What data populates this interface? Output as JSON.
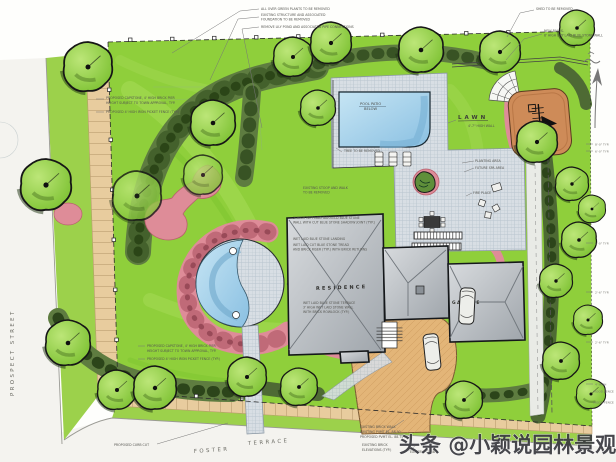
{
  "streets": {
    "prospect": "PROSPECT STREET",
    "foster": "FOSTER",
    "terrace": "TERRACE"
  },
  "labels": {
    "lawn": "LAWN",
    "residence": "RESIDENCE",
    "garage": "GARAGE",
    "pool_1": "POOL PATIO",
    "pool_2": "BELOW",
    "fire_place": "FIRE PLACE",
    "planting_area": "PLANTING AREA",
    "future_spa": "FUTURE SPA AREA"
  },
  "notes": {
    "green_plants": "ALL OVER GREEN PLANTS TO BE REMOVED",
    "existing_structure_1": "EXISTING STRUCTURE AND ASSOCIATED",
    "existing_structure_2": "FOUNDATION TO BE REMOVED",
    "lily_pond": "REMOVE LILY POND AND ASSOCIATED PIPE CONNECTIONS",
    "shed": "SHED TO BE REMOVED",
    "wall_1": "NEW BALUS.",
    "wall_2": "8' HIGH DRY LAID BLUE STONE WALL",
    "pier_a1": "PROPOSED CAPSTONE, 4' HIGH BRICK PIER",
    "pier_a2": "HEIGHT SUBJECT TO TOWN APPROVAL, TYP.",
    "fence_a": "PROPOSED 4' HIGH IRON PICKET FENCE (TYP.)",
    "pier_b1": "PROPOSED CAPSTONE, 4' HIGH BRICK PIER",
    "pier_b2": "HEIGHT SUBJECT TO TOWN APPROVAL, TYP.",
    "fence_b": "PROPOSED 4' HIGH IRON PICKET FENCE (TYP.)",
    "stoop_1": "EXISTING STOOP AND WALK",
    "stoop_2": "TO BE REMOVED",
    "wall_house_1": "3' HIGH WET LAID GARFIELD BLUE STONE",
    "wall_house_2": "WALL WITH CUT BLUE STONE SHADOW JOINT (TYP.)",
    "landing": "WET LAID BLUE STONE LANDING",
    "tread_1": "WET LAID CUT BLUE STONE TREAD",
    "tread_2": "AND BRICK RISER (TYP.) WITH BRICK RETURNS",
    "terrace_1": "WET LAID BLUE STONE TERRACE",
    "terrace_2": "3' HIGH WET LAID STONE WALL",
    "terrace_3": "WITH BRICK ROWLOCK (TYP.)",
    "tree_removed": "TREE TO BE REMOVED",
    "wall_hgt": "4'-7\" HIGH WALL",
    "curb_cut": "PROPOSED CURB CUT",
    "brick_walk_1": "EXISTING BRICK WALK",
    "brick_walk_2": "EXISTING PVMT EL. 88.90",
    "brick_walk_3": "PROPOSED PVMT EL. 88.75",
    "brick_elev_1": "EXISTING BRICK",
    "brick_elev_2": "ELEVATIONS (TYP.)",
    "existing_curb": "EXISTING CURB",
    "dims": [
      "8'-0\" TYP.",
      "6'-0\" TYP.",
      "6'-0\" TYP.",
      "2'-6\" TYP.",
      "2'-6\" TYP.",
      "4' HIGH",
      "WOOD FENCE",
      "WOOD FENCE"
    ]
  },
  "watermark": {
    "text": "头条 @小颖说园林景观",
    "color": "#3A3A40"
  },
  "colors": {
    "lawn": "#8FCF3B",
    "hedge": "#5E7C40",
    "pink": "#DE8C98",
    "pool": "#9FCDE8",
    "bluestone": "#D8DEE4",
    "roof": "#B9BEC4",
    "driveway": "#E3B578",
    "play_area": "#CE8B58",
    "sidewalk": "#E8CC9E"
  }
}
